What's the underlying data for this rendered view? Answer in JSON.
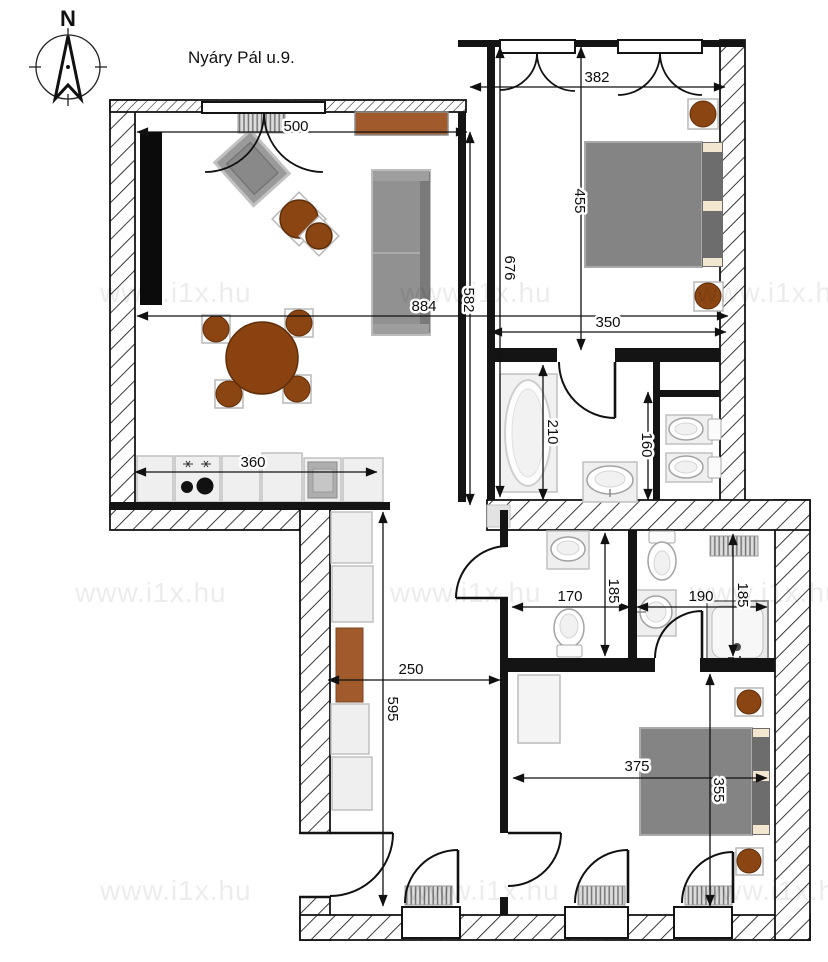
{
  "title": "Nyáry Pál u.9.",
  "compass": {
    "north_label": "N"
  },
  "watermark": {
    "text": "www.i1x.hu"
  },
  "colors": {
    "wall": "#141414",
    "furniture_gray": "#8a8a8a",
    "accent_brown": "#8b4513",
    "sideboard_brown": "#a05a2c",
    "fixture_light": "#efefef"
  },
  "dimensions": {
    "living_room_width": "500",
    "total_width": "884",
    "living_room_height": "582",
    "bedroom1_window_span": "382",
    "bedroom1_depth": "455",
    "right_wing_height": "676",
    "bedroom1_width": "350",
    "bathroom_height": "210",
    "wc_height": "160",
    "kitchen_counter": "360",
    "hallway_width": "250",
    "hallway_height": "595",
    "bathroom2_width": "170",
    "bathroom2_height": "185",
    "bathroom3_width": "190",
    "bathroom3_height": "185",
    "bedroom2_width": "375",
    "bedroom2_height": "355"
  }
}
